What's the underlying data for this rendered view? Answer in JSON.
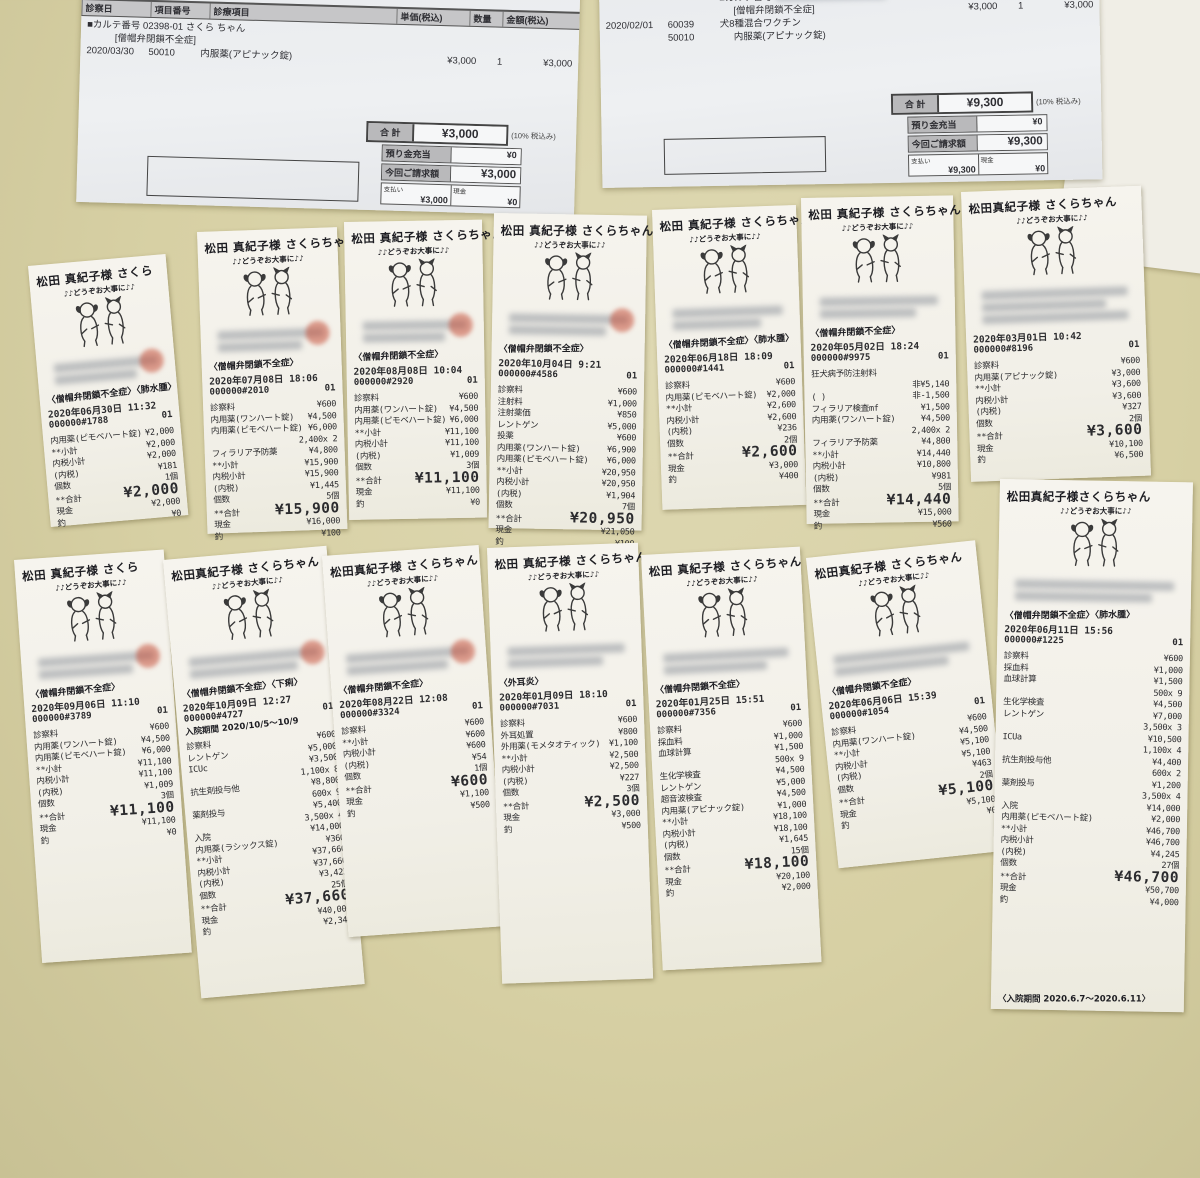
{
  "invoices": [
    {
      "header_cells": [
        "診察日",
        "項目番号",
        "診療項目",
        "単価(税込)",
        "数量",
        "金額(税込)"
      ],
      "lines": [
        {
          "name": "■カルテ番号 02398-01 さくら ちゃん",
          "span": true
        },
        {
          "name": "[僧帽弁閉鎖不全症]",
          "span": true,
          "indent": 1
        },
        {
          "date": "2020/03/30",
          "code": "50010",
          "name": "内服薬(アピナック錠)",
          "unit": "¥3,000",
          "qty": "1",
          "amt": "¥3,000"
        }
      ],
      "totals": {
        "total_label": "合 計",
        "total": "¥3,000",
        "tax_note": "(10% 税込み)",
        "rows": [
          {
            "l": "預り金充当",
            "v": "¥0"
          },
          {
            "l": "今回ご請求額",
            "v": "¥3,000"
          }
        ],
        "pay_label": "支払い",
        "pay": "¥3,000",
        "cash_label": "現金",
        "cash": "¥0"
      }
    },
    {
      "header_cells": [],
      "lines": [
        {
          "name": "■カルテ番号",
          "blur": true,
          "unit": "¥6,300",
          "qty": "1",
          "amt": "¥6,300"
        },
        {
          "name": "[僧帽弁閉鎖不全症]",
          "indent": 1,
          "unit": "¥3,000",
          "qty": "1",
          "amt": "¥3,000"
        },
        {
          "date": "2020/02/01",
          "code": "60039",
          "name": "犬8種混合ワクチン"
        },
        {
          "code": "50010",
          "name": "内服薬(アピナック錠)",
          "indent": 1
        }
      ],
      "totals": {
        "total_label": "合 計",
        "total": "¥9,300",
        "tax_note": "(10% 税込み)",
        "rows": [
          {
            "l": "預り金充当",
            "v": "¥0"
          },
          {
            "l": "今回ご請求額",
            "v": "¥9,300"
          }
        ],
        "pay_label": "支払い",
        "pay": "¥9,300",
        "cash_label": "現金",
        "cash": "¥0"
      }
    }
  ],
  "receipts": [
    {
      "customer": "松田 真紀子様 さくら",
      "greeting": "♪♪どうぞお大事に♪♪",
      "diagnosis": "〈僧帽弁閉鎖不全症〉〈肺水腫〉",
      "date": "2020年06月30日 11:32",
      "receipt_no": "000000#1788",
      "code": "01",
      "red_stamp": true,
      "note": "",
      "footer": "",
      "lines": [
        {
          "l": "内用薬(ピモベハート錠)",
          "v": "¥2,000"
        },
        {
          "l": "**小計",
          "v": "¥2,000"
        },
        {
          "l": "内税小計",
          "v": "¥2,000"
        },
        {
          "l": "(内税)",
          "v": "¥181"
        },
        {
          "l": "個数",
          "v": "1個"
        },
        {
          "l": "**合計",
          "v": "¥2,000",
          "big": true
        },
        {
          "l": "現金",
          "v": "¥2,000"
        },
        {
          "l": "釣",
          "v": "¥0"
        }
      ]
    },
    {
      "customer": "松田 真紀子様 さくらちゃん",
      "greeting": "♪♪どうぞお大事に♪♪",
      "diagnosis": "〈僧帽弁閉鎖不全症〉",
      "date": "2020年07月08日 18:06",
      "receipt_no": "000000#2010",
      "code": "01",
      "red_stamp": true,
      "note": "",
      "footer": "",
      "lines": [
        {
          "l": "診察料",
          "v": "¥600"
        },
        {
          "l": "内用薬(ワンハート錠)",
          "v": "¥4,500"
        },
        {
          "l": "内用薬(ピモベハート錠)",
          "v": "¥6,000"
        },
        {
          "l": "",
          "v": "2,400x 2"
        },
        {
          "l": "フィラリア予防薬",
          "v": "¥4,800"
        },
        {
          "l": "**小計",
          "v": "¥15,900"
        },
        {
          "l": "内税小計",
          "v": "¥15,900"
        },
        {
          "l": "(内税)",
          "v": "¥1,445"
        },
        {
          "l": "個数",
          "v": "5個"
        },
        {
          "l": "**合計",
          "v": "¥15,900",
          "big": true
        },
        {
          "l": "現金",
          "v": "¥16,000"
        },
        {
          "l": "釣",
          "v": "¥100"
        }
      ]
    },
    {
      "customer": "松田 真紀子様 さくらちゃん",
      "greeting": "♪♪どうぞお大事に♪♪",
      "diagnosis": "〈僧帽弁閉鎖不全症〉",
      "date": "2020年08月08日 10:04",
      "receipt_no": "000000#2920",
      "code": "01",
      "red_stamp": true,
      "note": "",
      "footer": "",
      "lines": [
        {
          "l": "診察料",
          "v": "¥600"
        },
        {
          "l": "内用薬(ワンハート錠)",
          "v": "¥4,500"
        },
        {
          "l": "内用薬(ピモベハート錠)",
          "v": "¥6,000"
        },
        {
          "l": "**小計",
          "v": "¥11,100"
        },
        {
          "l": "内税小計",
          "v": "¥11,100"
        },
        {
          "l": "(内税)",
          "v": "¥1,009"
        },
        {
          "l": "個数",
          "v": "3個"
        },
        {
          "l": "**合計",
          "v": "¥11,100",
          "big": true
        },
        {
          "l": "現金",
          "v": "¥11,100"
        },
        {
          "l": "釣",
          "v": "¥0"
        }
      ]
    },
    {
      "customer": "松田 真紀子様 さくらちゃん",
      "greeting": "♪♪どうぞお大事に♪♪",
      "diagnosis": "〈僧帽弁閉鎖不全症〉",
      "date": "2020年10月04日 9:21",
      "receipt_no": "000000#4586",
      "code": "01",
      "red_stamp": true,
      "note": "",
      "footer": "",
      "lines": [
        {
          "l": "診察料",
          "v": "¥600"
        },
        {
          "l": "注射料",
          "v": "¥1,000"
        },
        {
          "l": "注射薬価",
          "v": "¥850"
        },
        {
          "l": "レントゲン",
          "v": "¥5,000"
        },
        {
          "l": "投薬",
          "v": "¥600"
        },
        {
          "l": "内用薬(ワンハート錠)",
          "v": "¥6,900"
        },
        {
          "l": "内用薬(ピモベハート錠)",
          "v": "¥6,000"
        },
        {
          "l": "**小計",
          "v": "¥20,950"
        },
        {
          "l": "内税小計",
          "v": "¥20,950"
        },
        {
          "l": "(内税)",
          "v": "¥1,904"
        },
        {
          "l": "個数",
          "v": "7個"
        },
        {
          "l": "**合計",
          "v": "¥20,950",
          "big": true
        },
        {
          "l": "現金",
          "v": "¥21,050"
        },
        {
          "l": "釣",
          "v": "¥100"
        }
      ]
    },
    {
      "customer": "松田 真紀子様 さくらちゃん",
      "greeting": "♪♪どうぞお大事に♪♪",
      "diagnosis": "〈僧帽弁閉鎖不全症〉〈肺水腫〉",
      "date": "2020年06月18日 18:09",
      "receipt_no": "000000#1441",
      "code": "01",
      "red_stamp": false,
      "note": "",
      "footer": "",
      "lines": [
        {
          "l": "診察料",
          "v": "¥600"
        },
        {
          "l": "内用薬(ピモベハート錠)",
          "v": "¥2,000"
        },
        {
          "l": "**小計",
          "v": "¥2,600"
        },
        {
          "l": "内税小計",
          "v": "¥2,600"
        },
        {
          "l": "(内税)",
          "v": "¥236"
        },
        {
          "l": "個数",
          "v": "2個"
        },
        {
          "l": "**合計",
          "v": "¥2,600",
          "big": true
        },
        {
          "l": "現金",
          "v": "¥3,000"
        },
        {
          "l": "釣",
          "v": "¥400"
        }
      ]
    },
    {
      "customer": "松田 真紀子様 さくらちゃん",
      "greeting": "♪♪どうぞお大事に♪♪",
      "diagnosis": "〈僧帽弁閉鎖不全症〉",
      "date": "2020年05月02日 18:24",
      "receipt_no": "000000#9975",
      "code": "01",
      "red_stamp": false,
      "note": "",
      "footer": "",
      "lines": [
        {
          "l": "狂犬病予防注射料",
          "v": ""
        },
        {
          "l": "",
          "v": "非¥5,140"
        },
        {
          "l": "(  )",
          "v": "非-1,500"
        },
        {
          "l": "フィラリア検査mf",
          "v": "¥1,500"
        },
        {
          "l": "内用薬(ワンハート錠)",
          "v": "¥4,500"
        },
        {
          "l": "",
          "v": "2,400x 2"
        },
        {
          "l": "フィラリア予防薬",
          "v": "¥4,800"
        },
        {
          "l": "**小計",
          "v": "¥14,440"
        },
        {
          "l": "内税小計",
          "v": "¥10,800"
        },
        {
          "l": "(内税)",
          "v": "¥981"
        },
        {
          "l": "個数",
          "v": "5個"
        },
        {
          "l": "**合計",
          "v": "¥14,440",
          "big": true
        },
        {
          "l": "現金",
          "v": "¥15,000"
        },
        {
          "l": "釣",
          "v": "¥560"
        }
      ]
    },
    {
      "customer": "松田真紀子様 さくらちゃん",
      "greeting": "♪♪どうぞお大事に♪♪",
      "diagnosis": "",
      "date": "2020年03月01日 10:42",
      "receipt_no": "000000#8196",
      "code": "01",
      "red_stamp": false,
      "note": "",
      "footer": "",
      "lines": [
        {
          "l": "診察料",
          "v": "¥600"
        },
        {
          "l": "内用薬(アピナック錠)",
          "v": "¥3,000"
        },
        {
          "l": "**小計",
          "v": "¥3,600"
        },
        {
          "l": "内税小計",
          "v": "¥3,600"
        },
        {
          "l": "(内税)",
          "v": "¥327"
        },
        {
          "l": "個数",
          "v": "2個"
        },
        {
          "l": "**合計",
          "v": "¥3,600",
          "big": true
        },
        {
          "l": "現金",
          "v": "¥10,100"
        },
        {
          "l": "釣",
          "v": "¥6,500"
        }
      ]
    },
    {
      "customer": "松田 真紀子様 さくら",
      "greeting": "♪♪どうぞお大事に♪♪",
      "diagnosis": "〈僧帽弁閉鎖不全症〉",
      "date": "2020年09月06日 11:10",
      "receipt_no": "000000#3789",
      "code": "01",
      "red_stamp": true,
      "note": "",
      "footer": "",
      "lines": [
        {
          "l": "診察料",
          "v": "¥600"
        },
        {
          "l": "内用薬(ワンハート錠)",
          "v": "¥4,500"
        },
        {
          "l": "内用薬(ピモベハート錠)",
          "v": "¥6,000"
        },
        {
          "l": "**小計",
          "v": "¥11,100"
        },
        {
          "l": "内税小計",
          "v": "¥11,100"
        },
        {
          "l": "(内税)",
          "v": "¥1,009"
        },
        {
          "l": "個数",
          "v": "3個"
        },
        {
          "l": "**合計",
          "v": "¥11,100",
          "big": true
        },
        {
          "l": "現金",
          "v": "¥11,100"
        },
        {
          "l": "釣",
          "v": "¥0"
        }
      ]
    },
    {
      "customer": "松田真紀子様 さくらちゃん",
      "greeting": "♪♪どうぞお大事に♪♪",
      "diagnosis": "〈僧帽弁閉鎖不全症〉〈下痢〉",
      "date": "2020年10月09日 12:27",
      "receipt_no": "000000#4727",
      "code": "01",
      "red_stamp": true,
      "note": "入院期間 2020/10/5～10/9",
      "footer": "",
      "lines": [
        {
          "l": "診察料",
          "v": "¥600"
        },
        {
          "l": "レントゲン",
          "v": "¥5,000"
        },
        {
          "l": "ICUc",
          "v": "¥3,500"
        },
        {
          "l": "",
          "v": "1,100x 8"
        },
        {
          "l": "抗生剤投与他",
          "v": "¥8,800"
        },
        {
          "l": "",
          "v": "600x 9"
        },
        {
          "l": "薬剤投与",
          "v": "¥5,400"
        },
        {
          "l": "",
          "v": "3,500x 4"
        },
        {
          "l": "入院",
          "v": "¥14,000"
        },
        {
          "l": "内用薬(ラシックス錠)",
          "v": "¥360"
        },
        {
          "l": "**小計",
          "v": "¥37,660"
        },
        {
          "l": "内税小計",
          "v": "¥37,660"
        },
        {
          "l": "(内税)",
          "v": "¥3,423"
        },
        {
          "l": "個数",
          "v": "25個"
        },
        {
          "l": "**合計",
          "v": "¥37,660",
          "big": true
        },
        {
          "l": "現金",
          "v": "¥40,000"
        },
        {
          "l": "釣",
          "v": "¥2,340"
        }
      ]
    },
    {
      "customer": "松田真紀子様 さくらちゃん",
      "greeting": "♪♪どうぞお大事に♪♪",
      "diagnosis": "〈僧帽弁閉鎖不全症〉",
      "date": "2020年08月22日 12:08",
      "receipt_no": "000000#3324",
      "code": "01",
      "red_stamp": true,
      "note": "",
      "footer": "",
      "lines": [
        {
          "l": "診察料",
          "v": "¥600"
        },
        {
          "l": "**小計",
          "v": "¥600"
        },
        {
          "l": "内税小計",
          "v": "¥600"
        },
        {
          "l": "(内税)",
          "v": "¥54"
        },
        {
          "l": "個数",
          "v": "1個"
        },
        {
          "l": "**合計",
          "v": "¥600",
          "big": true
        },
        {
          "l": "現金",
          "v": "¥1,100"
        },
        {
          "l": "釣",
          "v": "¥500"
        }
      ]
    },
    {
      "customer": "松田 真紀子様 さくらちゃん",
      "greeting": "♪♪どうぞお大事に♪♪",
      "diagnosis": "〈外耳炎〉",
      "date": "2020年01月09日 18:10",
      "receipt_no": "000000#7031",
      "code": "01",
      "red_stamp": false,
      "note": "",
      "footer": "",
      "lines": [
        {
          "l": "診察料",
          "v": "¥600"
        },
        {
          "l": "外耳処置",
          "v": "¥800"
        },
        {
          "l": "外用薬(モメタオティック)",
          "v": "¥1,100"
        },
        {
          "l": "**小計",
          "v": "¥2,500"
        },
        {
          "l": "内税小計",
          "v": "¥2,500"
        },
        {
          "l": "(内税)",
          "v": "¥227"
        },
        {
          "l": "個数",
          "v": "3個"
        },
        {
          "l": "**合計",
          "v": "¥2,500",
          "big": true
        },
        {
          "l": "現金",
          "v": "¥3,000"
        },
        {
          "l": "釣",
          "v": "¥500"
        }
      ]
    },
    {
      "customer": "松田 真紀子様 さくらちゃん",
      "greeting": "♪♪どうぞお大事に♪♪",
      "diagnosis": "〈僧帽弁閉鎖不全症〉",
      "date": "2020年01月25日 15:51",
      "receipt_no": "000000#7356",
      "code": "01",
      "red_stamp": false,
      "note": "",
      "footer": "",
      "lines": [
        {
          "l": "診察料",
          "v": "¥600"
        },
        {
          "l": "採血料",
          "v": "¥1,000"
        },
        {
          "l": "血球計算",
          "v": "¥1,500"
        },
        {
          "l": "",
          "v": "500x 9"
        },
        {
          "l": "生化学検査",
          "v": "¥4,500"
        },
        {
          "l": "レントゲン",
          "v": "¥5,000"
        },
        {
          "l": "超音波検査",
          "v": "¥4,500"
        },
        {
          "l": "内用薬(アピナック錠)",
          "v": "¥1,000"
        },
        {
          "l": "**小計",
          "v": "¥18,100"
        },
        {
          "l": "内税小計",
          "v": "¥18,100"
        },
        {
          "l": "(内税)",
          "v": "¥1,645"
        },
        {
          "l": "個数",
          "v": "15個"
        },
        {
          "l": "**合計",
          "v": "¥18,100",
          "big": true
        },
        {
          "l": "現金",
          "v": "¥20,100"
        },
        {
          "l": "釣",
          "v": "¥2,000"
        }
      ]
    },
    {
      "customer": "松田真紀子様 さくらちゃん",
      "greeting": "♪♪どうぞお大事に♪♪",
      "diagnosis": "〈僧帽弁閉鎖不全症〉",
      "date": "2020年06月06日 15:39",
      "receipt_no": "000000#1054",
      "code": "01",
      "red_stamp": false,
      "note": "",
      "footer": "",
      "lines": [
        {
          "l": "診察料",
          "v": "¥600"
        },
        {
          "l": "内用薬(ワンハート錠)",
          "v": "¥4,500"
        },
        {
          "l": "**小計",
          "v": "¥5,100"
        },
        {
          "l": "内税小計",
          "v": "¥5,100"
        },
        {
          "l": "(内税)",
          "v": "¥463"
        },
        {
          "l": "個数",
          "v": "2個"
        },
        {
          "l": "**合計",
          "v": "¥5,100",
          "big": true
        },
        {
          "l": "現金",
          "v": "¥5,100"
        },
        {
          "l": "釣",
          "v": "¥0"
        }
      ]
    },
    {
      "customer": "松田真紀子様さくらちゃん",
      "greeting": "♪♪どうぞお大事に♪♪",
      "diagnosis": "〈僧帽弁閉鎖不全症〉〈肺水腫〉",
      "date": "2020年06月11日 15:56",
      "receipt_no": "000000#1225",
      "code": "01",
      "red_stamp": false,
      "note": "",
      "footer": "〈入院期間 2020.6.7～2020.6.11〉",
      "lines": [
        {
          "l": "診察料",
          "v": "¥600"
        },
        {
          "l": "採血料",
          "v": "¥1,000"
        },
        {
          "l": "血球計算",
          "v": "¥1,500"
        },
        {
          "l": "",
          "v": "500x 9"
        },
        {
          "l": "生化学検査",
          "v": "¥4,500"
        },
        {
          "l": "レントゲン",
          "v": "¥7,000"
        },
        {
          "l": "",
          "v": "3,500x 3"
        },
        {
          "l": "ICUa",
          "v": "¥10,500"
        },
        {
          "l": "",
          "v": "1,100x 4"
        },
        {
          "l": "抗生剤投与他",
          "v": "¥4,400"
        },
        {
          "l": "",
          "v": "600x 2"
        },
        {
          "l": "薬剤投与",
          "v": "¥1,200"
        },
        {
          "l": "",
          "v": "3,500x 4"
        },
        {
          "l": "入院",
          "v": "¥14,000"
        },
        {
          "l": "内用薬(ピモベハート錠)",
          "v": "¥2,000"
        },
        {
          "l": "**小計",
          "v": "¥46,700"
        },
        {
          "l": "内税小計",
          "v": "¥46,700"
        },
        {
          "l": "(内税)",
          "v": "¥4,245"
        },
        {
          "l": "個数",
          "v": "27個"
        },
        {
          "l": "**合計",
          "v": "¥46,700",
          "big": true
        },
        {
          "l": "現金",
          "v": "¥50,700"
        },
        {
          "l": "釣",
          "v": "¥4,000"
        }
      ]
    }
  ]
}
